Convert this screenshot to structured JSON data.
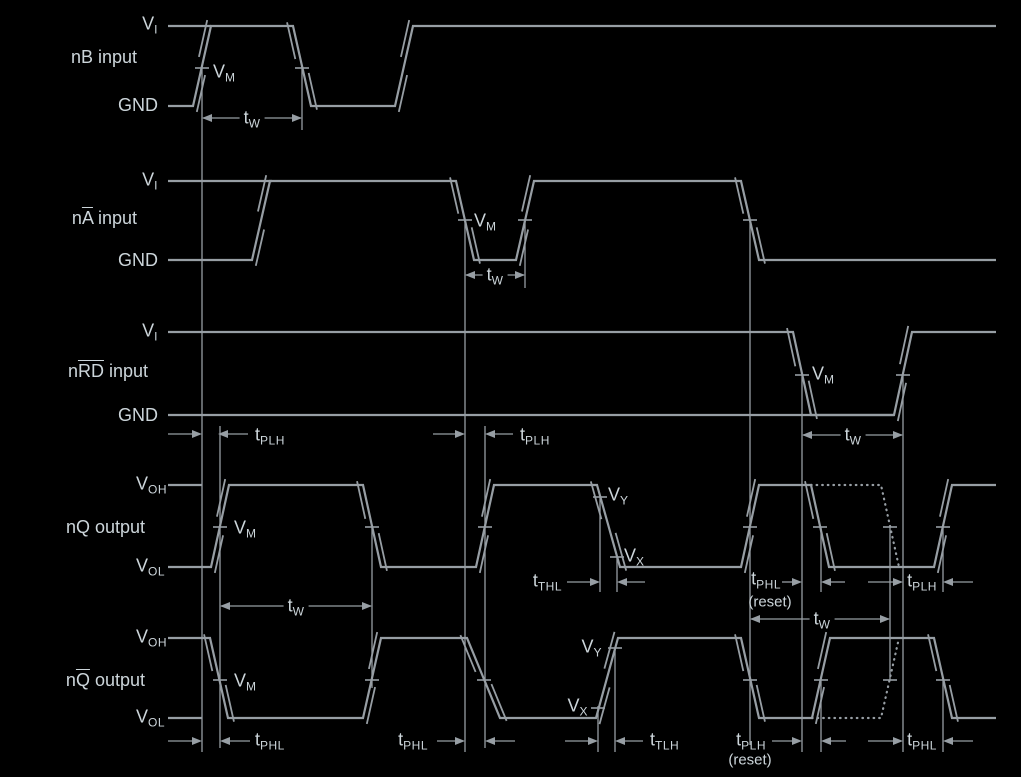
{
  "figure": {
    "width": 1021,
    "height": 777,
    "kind": "timing-diagram"
  },
  "colors": {
    "background": "#000000",
    "line": "#979ea4",
    "text": "#ccd5da"
  },
  "signals": [
    {
      "id": "nB",
      "label": "nB input",
      "high_ref": "VI",
      "low_ref": "GND"
    },
    {
      "id": "nA",
      "label": "nA input (A overbar)",
      "high_ref": "VI",
      "low_ref": "GND"
    },
    {
      "id": "nRD",
      "label": "nRD input (RD overbar)",
      "high_ref": "VI",
      "low_ref": "GND"
    },
    {
      "id": "nQ",
      "label": "nQ output",
      "high_ref": "VOH",
      "low_ref": "VOL"
    },
    {
      "id": "nQb",
      "label": "nQ output (Q overbar)",
      "high_ref": "VOH",
      "low_ref": "VOL"
    }
  ],
  "texts": [
    {
      "name": "nB-vi-label",
      "x": 158,
      "y": 25,
      "align": "right",
      "parts": [
        {
          "t": "V"
        },
        {
          "t": "I",
          "sub": true
        }
      ]
    },
    {
      "name": "nB-row-label",
      "x": 137,
      "y": 57,
      "align": "right",
      "parts": [
        {
          "t": "nB input"
        }
      ]
    },
    {
      "name": "nB-gnd-label",
      "x": 158,
      "y": 105,
      "align": "right",
      "parts": [
        {
          "t": "GND"
        }
      ]
    },
    {
      "name": "nB-vm-label",
      "x": 213,
      "y": 73,
      "align": "left",
      "parts": [
        {
          "t": "V"
        },
        {
          "t": "M",
          "sub": true
        }
      ]
    },
    {
      "name": "nB-tw-label",
      "x": 252,
      "y": 119,
      "align": "center",
      "bg": true,
      "parts": [
        {
          "t": "t"
        },
        {
          "t": "W",
          "sub": true
        }
      ]
    },
    {
      "name": "nA-vi-label",
      "x": 158,
      "y": 181,
      "align": "right",
      "parts": [
        {
          "t": "V"
        },
        {
          "t": "I",
          "sub": true
        }
      ]
    },
    {
      "name": "nA-row-label",
      "x": 137,
      "y": 218,
      "align": "right",
      "parts": [
        {
          "t": "n"
        },
        {
          "t": "A",
          "over": true
        },
        {
          "t": " input"
        }
      ]
    },
    {
      "name": "nA-gnd-label",
      "x": 158,
      "y": 260,
      "align": "right",
      "parts": [
        {
          "t": "GND"
        }
      ]
    },
    {
      "name": "nA-vm-label",
      "x": 474,
      "y": 222,
      "align": "left",
      "parts": [
        {
          "t": "V"
        },
        {
          "t": "M",
          "sub": true
        }
      ]
    },
    {
      "name": "nA-tw-label",
      "x": 495,
      "y": 276,
      "align": "center",
      "bg": true,
      "parts": [
        {
          "t": "t"
        },
        {
          "t": "W",
          "sub": true
        }
      ]
    },
    {
      "name": "nRD-vi-label",
      "x": 158,
      "y": 332,
      "align": "right",
      "parts": [
        {
          "t": "V"
        },
        {
          "t": "I",
          "sub": true
        }
      ]
    },
    {
      "name": "nRD-row-label",
      "x": 148,
      "y": 371,
      "align": "right",
      "parts": [
        {
          "t": "n"
        },
        {
          "t": "RD",
          "over": true
        },
        {
          "t": " input"
        }
      ]
    },
    {
      "name": "nRD-gnd-label",
      "x": 158,
      "y": 415,
      "align": "right",
      "parts": [
        {
          "t": "GND"
        }
      ]
    },
    {
      "name": "nRD-vm-label",
      "x": 812,
      "y": 375,
      "align": "left",
      "parts": [
        {
          "t": "V"
        },
        {
          "t": "M",
          "sub": true
        }
      ]
    },
    {
      "name": "nRD-tw-label",
      "x": 853,
      "y": 436,
      "align": "center",
      "bg": true,
      "parts": [
        {
          "t": "t"
        },
        {
          "t": "W",
          "sub": true
        }
      ]
    },
    {
      "name": "tplh-label-1",
      "x": 255,
      "y": 436,
      "align": "left",
      "parts": [
        {
          "t": "t"
        },
        {
          "t": "PLH",
          "sub": true
        }
      ]
    },
    {
      "name": "tplh-label-2",
      "x": 520,
      "y": 436,
      "align": "left",
      "parts": [
        {
          "t": "t"
        },
        {
          "t": "PLH",
          "sub": true
        }
      ]
    },
    {
      "name": "nQ-voh-label",
      "x": 167,
      "y": 485,
      "align": "right",
      "parts": [
        {
          "t": "V"
        },
        {
          "t": "OH",
          "sub": true
        }
      ]
    },
    {
      "name": "nQ-row-label",
      "x": 145,
      "y": 527,
      "align": "right",
      "parts": [
        {
          "t": "nQ output"
        }
      ]
    },
    {
      "name": "nQ-vol-label",
      "x": 165,
      "y": 567,
      "align": "right",
      "parts": [
        {
          "t": "V"
        },
        {
          "t": "OL",
          "sub": true
        }
      ]
    },
    {
      "name": "nQ-vm-label",
      "x": 234,
      "y": 529,
      "align": "left",
      "parts": [
        {
          "t": "V"
        },
        {
          "t": "M",
          "sub": true
        }
      ]
    },
    {
      "name": "nQ-vy-label",
      "x": 608,
      "y": 496,
      "align": "left",
      "parts": [
        {
          "t": "V"
        },
        {
          "t": "Y",
          "sub": true
        }
      ]
    },
    {
      "name": "nQ-vx-label",
      "x": 624,
      "y": 557,
      "align": "left",
      "parts": [
        {
          "t": "V"
        },
        {
          "t": "X",
          "sub": true
        }
      ]
    },
    {
      "name": "nQ-tw-label",
      "x": 296,
      "y": 607,
      "align": "center",
      "bg": true,
      "parts": [
        {
          "t": "t"
        },
        {
          "t": "W",
          "sub": true
        }
      ]
    },
    {
      "name": "tthl-label",
      "x": 562,
      "y": 582,
      "align": "right",
      "parts": [
        {
          "t": "t"
        },
        {
          "t": "THL",
          "sub": true
        }
      ]
    },
    {
      "name": "tphl-reset-label",
      "x": 781,
      "y": 580,
      "align": "right",
      "parts": [
        {
          "t": "t"
        },
        {
          "t": "PHL",
          "sub": true
        }
      ]
    },
    {
      "name": "tphl-reset-sub-label",
      "x": 770,
      "y": 602,
      "align": "center",
      "size": 15,
      "parts": [
        {
          "t": "(reset)"
        }
      ]
    },
    {
      "name": "tplh-label-3",
      "x": 922,
      "y": 582,
      "align": "center",
      "parts": [
        {
          "t": "t"
        },
        {
          "t": "PLH",
          "sub": true
        }
      ]
    },
    {
      "name": "tw-reset-label",
      "x": 822,
      "y": 620,
      "align": "center",
      "bg": true,
      "parts": [
        {
          "t": "t"
        },
        {
          "t": "W",
          "sub": true
        }
      ]
    },
    {
      "name": "nQb-voh-label",
      "x": 167,
      "y": 638,
      "align": "right",
      "parts": [
        {
          "t": "V"
        },
        {
          "t": "OH",
          "sub": true
        }
      ]
    },
    {
      "name": "nQb-row-label",
      "x": 145,
      "y": 680,
      "align": "right",
      "parts": [
        {
          "t": "n"
        },
        {
          "t": "Q",
          "over": true
        },
        {
          "t": " output"
        }
      ]
    },
    {
      "name": "nQb-vol-label",
      "x": 165,
      "y": 718,
      "align": "right",
      "parts": [
        {
          "t": "V"
        },
        {
          "t": "OL",
          "sub": true
        }
      ]
    },
    {
      "name": "nQb-vm-label",
      "x": 234,
      "y": 682,
      "align": "left",
      "parts": [
        {
          "t": "V"
        },
        {
          "t": "M",
          "sub": true
        }
      ]
    },
    {
      "name": "nQb-vy-label",
      "x": 602,
      "y": 648,
      "align": "right",
      "parts": [
        {
          "t": "V"
        },
        {
          "t": "Y",
          "sub": true
        }
      ]
    },
    {
      "name": "nQb-vx-label",
      "x": 588,
      "y": 707,
      "align": "right",
      "parts": [
        {
          "t": "V"
        },
        {
          "t": "X",
          "sub": true
        }
      ]
    },
    {
      "name": "tphl-label-4",
      "x": 255,
      "y": 741,
      "align": "left",
      "parts": [
        {
          "t": "t"
        },
        {
          "t": "PHL",
          "sub": true
        }
      ]
    },
    {
      "name": "tphl-label-5",
      "x": 428,
      "y": 741,
      "align": "right",
      "parts": [
        {
          "t": "t"
        },
        {
          "t": "PHL",
          "sub": true
        }
      ]
    },
    {
      "name": "ttlh-label",
      "x": 650,
      "y": 741,
      "align": "left",
      "parts": [
        {
          "t": "t"
        },
        {
          "t": "TLH",
          "sub": true
        }
      ]
    },
    {
      "name": "tplh-reset2-label",
      "x": 766,
      "y": 741,
      "align": "right",
      "parts": [
        {
          "t": "t"
        },
        {
          "t": "PLH",
          "sub": true
        }
      ]
    },
    {
      "name": "tplh-reset2-sub-label",
      "x": 750,
      "y": 760,
      "align": "center",
      "size": 15,
      "parts": [
        {
          "t": "(reset)"
        }
      ]
    },
    {
      "name": "tphl-label-6",
      "x": 922,
      "y": 741,
      "align": "center",
      "parts": [
        {
          "t": "t"
        },
        {
          "t": "PHL",
          "sub": true
        }
      ]
    }
  ],
  "waveforms": [
    {
      "name": "nB-input",
      "solid": [
        [
          [
            168,
            106
          ],
          [
            193,
            106
          ],
          [
            211,
            26
          ],
          [
            293,
            26
          ],
          [
            311,
            106
          ],
          [
            395,
            106
          ],
          [
            413,
            26
          ],
          [
            996,
            26
          ]
        ]
      ],
      "stubs": [
        [
          168,
          26,
          211,
          26
        ]
      ],
      "dotted": []
    },
    {
      "name": "nA-input",
      "solid": [
        [
          [
            168,
            260
          ],
          [
            252,
            260
          ],
          [
            270,
            181
          ],
          [
            456,
            181
          ],
          [
            474,
            260
          ],
          [
            516,
            260
          ],
          [
            534,
            181
          ],
          [
            741,
            181
          ],
          [
            759,
            260
          ],
          [
            996,
            260
          ]
        ]
      ],
      "stubs": [
        [
          168,
          181,
          272,
          181
        ]
      ],
      "dotted": []
    },
    {
      "name": "nRD-input",
      "solid": [
        [
          [
            168,
            332
          ],
          [
            793,
            332
          ],
          [
            811,
            415
          ],
          [
            894,
            415
          ],
          [
            912,
            332
          ],
          [
            996,
            332
          ]
        ]
      ],
      "stubs": [
        [
          168,
          415,
          894,
          415
        ]
      ],
      "dotted": []
    },
    {
      "name": "nQ-output",
      "solid": [
        [
          [
            168,
            567
          ],
          [
            211,
            567
          ],
          [
            229,
            485
          ],
          [
            363,
            485
          ],
          [
            381,
            567
          ],
          [
            476,
            567
          ],
          [
            494,
            485
          ],
          [
            597,
            485
          ],
          [
            620,
            567
          ],
          [
            741,
            567
          ],
          [
            759,
            485
          ],
          [
            811,
            485
          ],
          [
            829,
            567
          ],
          [
            934,
            567
          ],
          [
            952,
            485
          ],
          [
            996,
            485
          ]
        ]
      ],
      "stubs": [
        [
          168,
          485,
          202,
          485
        ]
      ],
      "dotted": [
        [
          [
            811,
            485
          ],
          [
            881,
            485
          ],
          [
            899,
            567
          ]
        ]
      ]
    },
    {
      "name": "nQbar-output",
      "solid": [
        [
          [
            168,
            638
          ],
          [
            210,
            638
          ],
          [
            228,
            718
          ],
          [
            363,
            718
          ],
          [
            381,
            638
          ],
          [
            467,
            638
          ],
          [
            500,
            718
          ],
          [
            596,
            718
          ],
          [
            618,
            638
          ],
          [
            741,
            638
          ],
          [
            759,
            718
          ],
          [
            812,
            718
          ],
          [
            830,
            638
          ],
          [
            934,
            638
          ],
          [
            952,
            718
          ],
          [
            996,
            718
          ]
        ]
      ],
      "stubs": [
        [
          168,
          718,
          202,
          718
        ]
      ],
      "dotted": [
        [
          [
            812,
            718
          ],
          [
            881,
            718
          ],
          [
            899,
            638
          ]
        ]
      ]
    }
  ],
  "vlines": [
    [
      202,
      68,
      752
    ],
    [
      302,
      68,
      130
    ],
    [
      465,
      220,
      752
    ],
    [
      525,
      220,
      288
    ],
    [
      750,
      220,
      745
    ],
    [
      802,
      375,
      752
    ],
    [
      903,
      375,
      752
    ],
    [
      220,
      426,
      748
    ],
    [
      485,
      426,
      748
    ],
    [
      372,
      527,
      688
    ],
    [
      600,
      497,
      592
    ],
    [
      617,
      557,
      592
    ],
    [
      821,
      527,
      592
    ],
    [
      943,
      527,
      592
    ],
    [
      890,
      527,
      680
    ],
    [
      598,
      706,
      752
    ],
    [
      615,
      648,
      752
    ],
    [
      821,
      680,
      752
    ],
    [
      943,
      680,
      752
    ]
  ],
  "ticks": [
    [
      202,
      68
    ],
    [
      302,
      68
    ],
    [
      465,
      220
    ],
    [
      525,
      220
    ],
    [
      750,
      220
    ],
    [
      802,
      375
    ],
    [
      903,
      375
    ],
    [
      220,
      527
    ],
    [
      372,
      527
    ],
    [
      485,
      527
    ],
    [
      600,
      497
    ],
    [
      617,
      557
    ],
    [
      750,
      527
    ],
    [
      820,
      527
    ],
    [
      890,
      527
    ],
    [
      943,
      527
    ],
    [
      220,
      680
    ],
    [
      372,
      680
    ],
    [
      484,
      680
    ],
    [
      598,
      708
    ],
    [
      615,
      648
    ],
    [
      750,
      680
    ],
    [
      821,
      680
    ],
    [
      890,
      680
    ],
    [
      943,
      680
    ]
  ],
  "spans": [
    {
      "name": "tw-nB",
      "y": 118,
      "x1": 202,
      "x2": 302
    },
    {
      "name": "tw-nA",
      "y": 275,
      "x1": 465,
      "x2": 525
    },
    {
      "name": "tw-nRD",
      "y": 435,
      "x1": 802,
      "x2": 903
    },
    {
      "name": "tw-nQ",
      "y": 606,
      "x1": 220,
      "x2": 372
    },
    {
      "name": "tw-reset",
      "y": 619,
      "x1": 750,
      "x2": 890
    }
  ],
  "gaps": [
    {
      "name": "tplh-1",
      "y": 434,
      "x1": 202,
      "x2": 218,
      "t1": 34,
      "t2": 30
    },
    {
      "name": "tplh-2",
      "y": 434,
      "x1": 465,
      "x2": 485,
      "t1": 32,
      "t2": 28
    },
    {
      "name": "tthl",
      "y": 582,
      "x1": 600,
      "x2": 617,
      "t1": 33,
      "t2": 28
    },
    {
      "name": "tphl-reset",
      "y": 582,
      "x1": 802,
      "x2": 821,
      "t1": 20,
      "t2": 24
    },
    {
      "name": "tplh-3",
      "y": 582,
      "x1": 903,
      "x2": 943,
      "t1": 35,
      "t2": 30
    },
    {
      "name": "tphl-4",
      "y": 741,
      "x1": 202,
      "x2": 220,
      "t1": 34,
      "t2": 30
    },
    {
      "name": "tphl-5",
      "y": 741,
      "x1": 465,
      "x2": 485,
      "t1": 28,
      "t2": 30
    },
    {
      "name": "ttlh",
      "y": 741,
      "x1": 598,
      "x2": 615,
      "t1": 33,
      "t2": 28
    },
    {
      "name": "tplh-reset2",
      "y": 741,
      "x1": 802,
      "x2": 821,
      "t1": 30,
      "t2": 25
    },
    {
      "name": "tphl-6",
      "y": 741,
      "x1": 903,
      "x2": 943,
      "t1": 35,
      "t2": 30
    }
  ]
}
